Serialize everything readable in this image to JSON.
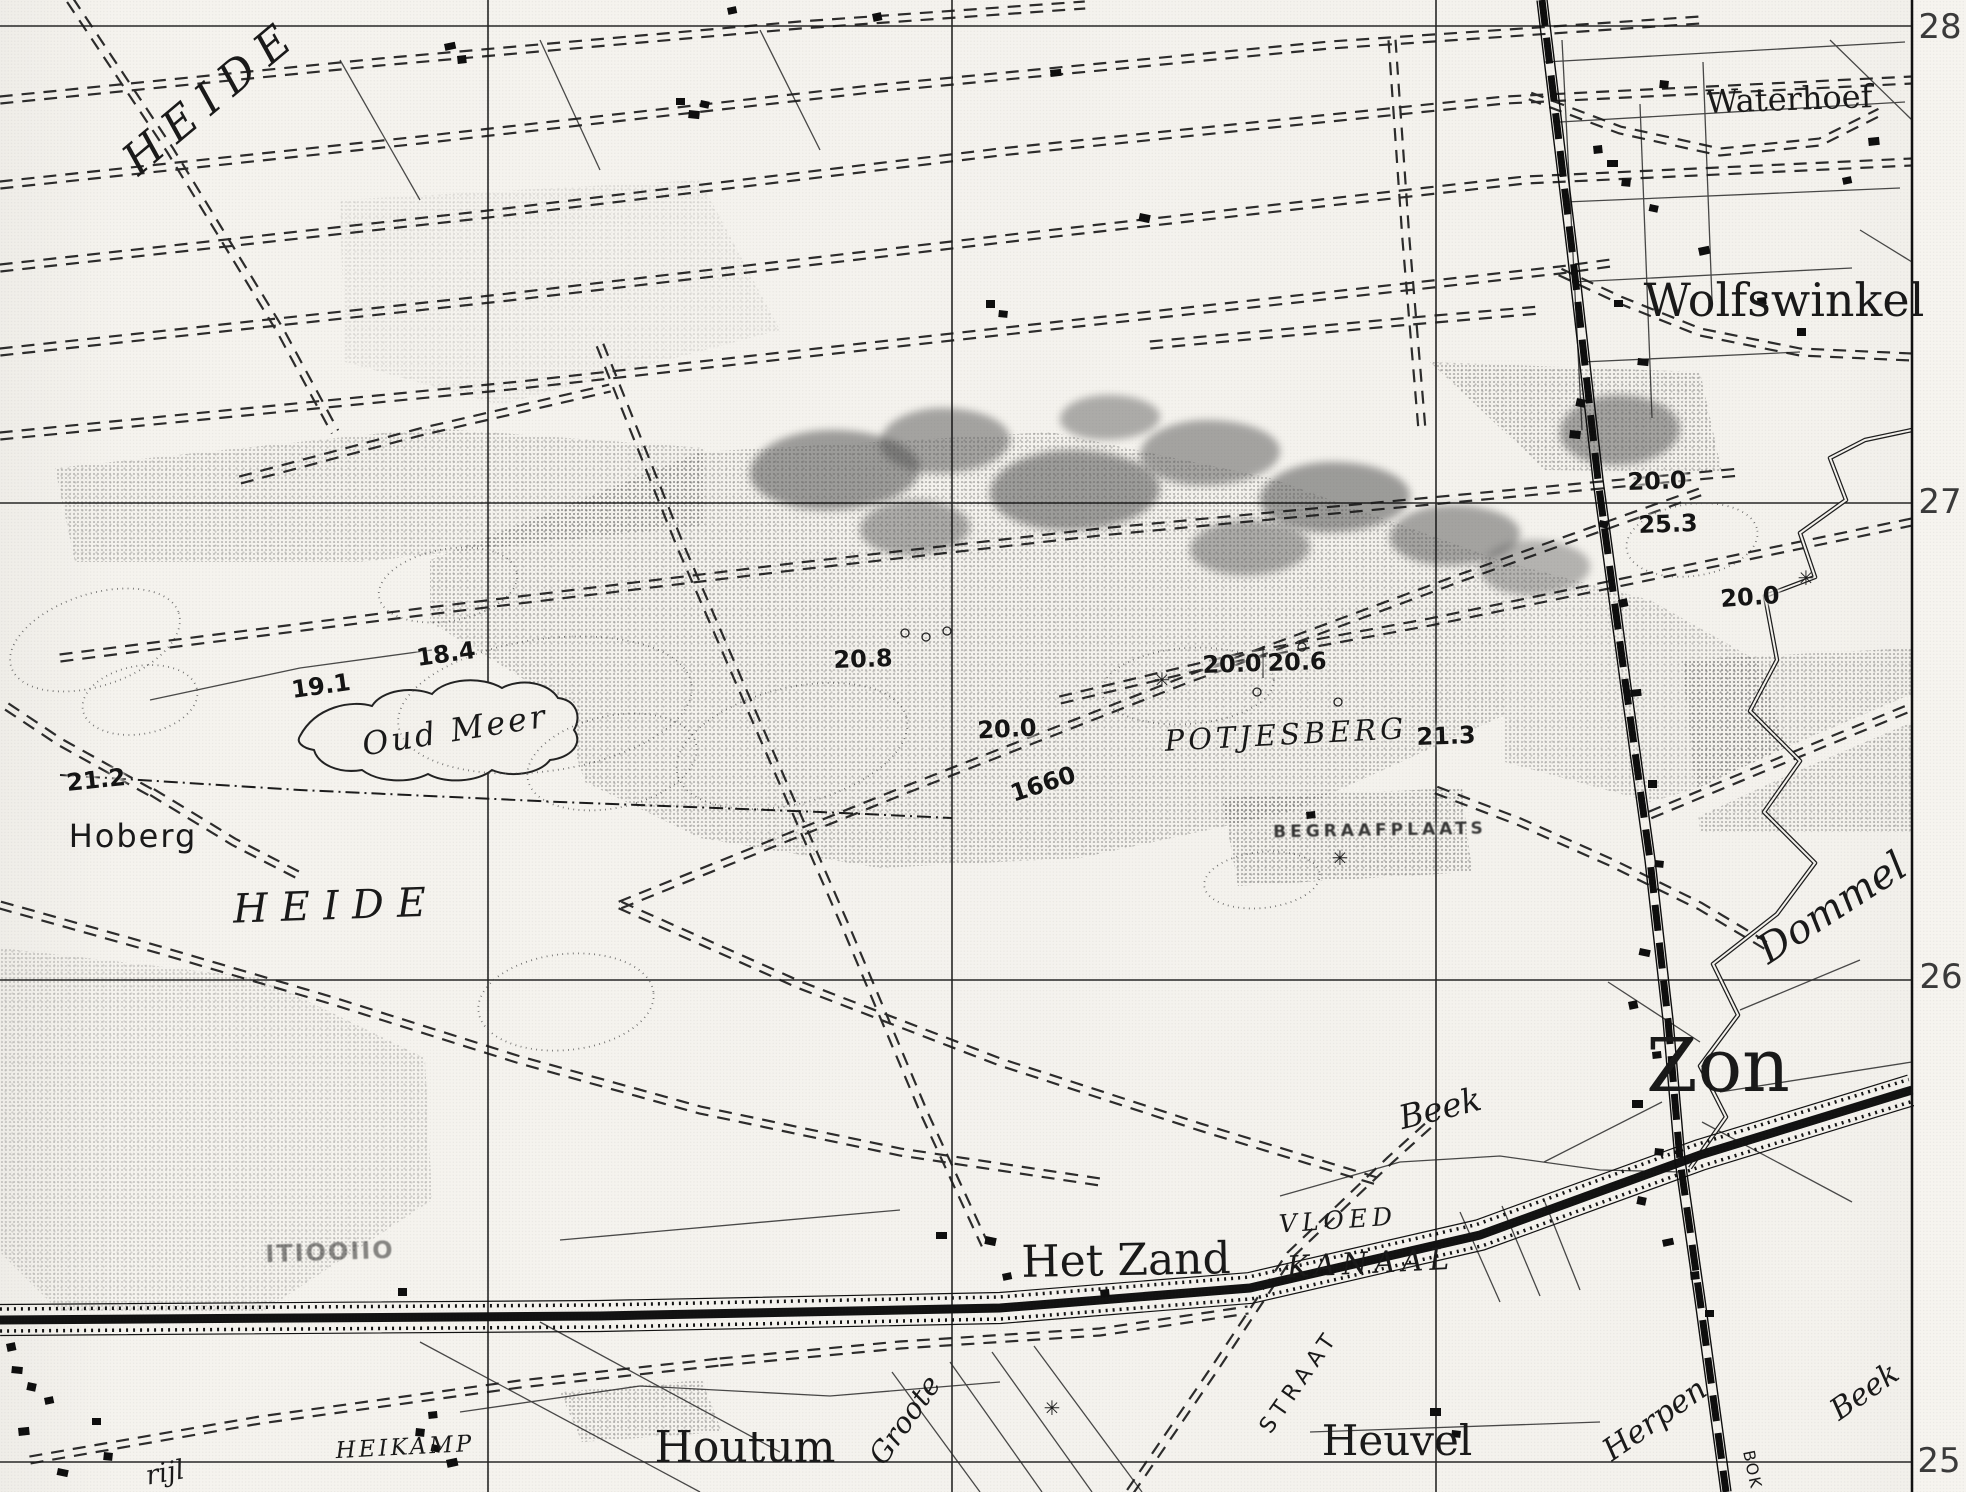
{
  "colors": {
    "ink": "#1b1b1b",
    "paper": "#f4f2ed"
  },
  "grid_numbers": [
    "28",
    "27",
    "26",
    "25"
  ],
  "labels": {
    "heide_north": "HEIDE",
    "waterhoef": "Waterhoef",
    "wolfswinkel": "Wolfswinkel",
    "oud_meer": "Oud Meer",
    "hoberg": "Hoberg",
    "heide_south": "HEIDE",
    "potjesberg": "POTJESBERG",
    "begraafplaats": "BEGRAAFPLAATS",
    "dommel": "Dommel",
    "zon": "Zon",
    "beek_north": "Beek",
    "vloed": "VLOED",
    "kanaal": "KANAAL",
    "het_zand": "Het Zand",
    "heikamp": "HEIKAMP",
    "houtum": "Houtum",
    "groote": "Groote",
    "straat": "STRAAT",
    "heuvel": "Heuvel",
    "herpen": "Herpen",
    "beek_south": "Beek",
    "bokt": "BOK",
    "rijt_fragment": "rijl",
    "faint_marks": "ITIOOIIO"
  },
  "spot_heights": [
    "21.2",
    "19.1",
    "18.4",
    "20.8",
    "20.0",
    "1660",
    "20.0",
    "20.6",
    "21.3",
    "20.0",
    "25.3",
    "20.0"
  ],
  "symbols": {
    "settlement_star": "✳"
  }
}
